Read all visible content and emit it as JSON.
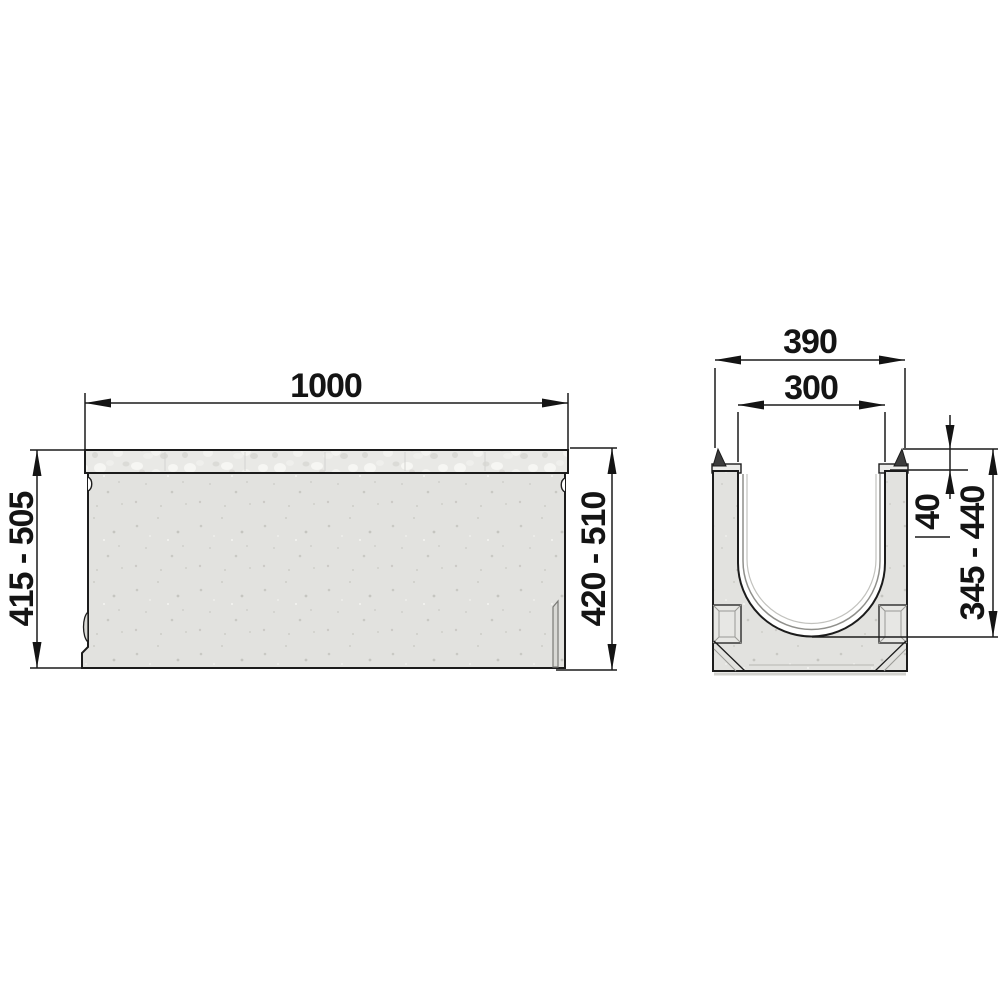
{
  "side_view": {
    "length": "1000",
    "height_left": "415 - 505",
    "height_right": "420 - 510"
  },
  "cross_section": {
    "outer_width": "390",
    "inner_width": "300",
    "edge_height": "40",
    "inner_depth": "345 - 440"
  },
  "colors": {
    "background": "#ffffff",
    "line": "#1c1c1c",
    "concrete": "#e2e2df",
    "concrete_speckle": "#c9c9c4",
    "grating_strip": "#e9e9e6",
    "edge_rail": "#3c3c3c",
    "inner_contour": "#8f8f8b"
  }
}
